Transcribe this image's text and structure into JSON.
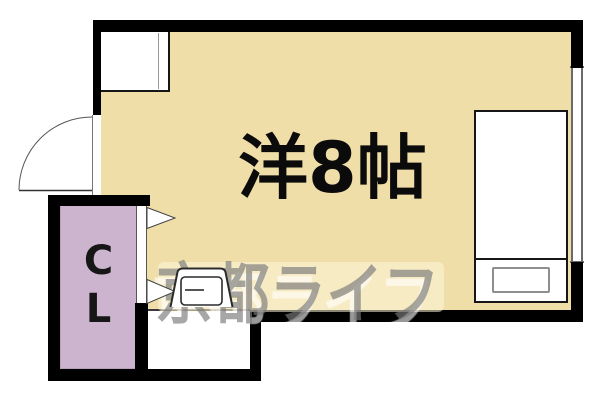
{
  "page": {
    "type": "apartment-floor-plan"
  },
  "room": {
    "label": "洋8帖"
  },
  "closet": {
    "letter_top": "C",
    "letter_bottom": "L"
  },
  "watermark": {
    "text": "京都ライフ"
  },
  "colors": {
    "room_fill": "#f0dea8",
    "closet_fill": "#cdb4ce",
    "wall": "#000000",
    "watermark_band": "#fdf6d9"
  },
  "icons": {
    "entry_door": "door-swing-arc",
    "closet_door": "folding-door-triangles",
    "furniture": [
      "kitchen-unit",
      "bed",
      "pillow",
      "chair"
    ]
  }
}
